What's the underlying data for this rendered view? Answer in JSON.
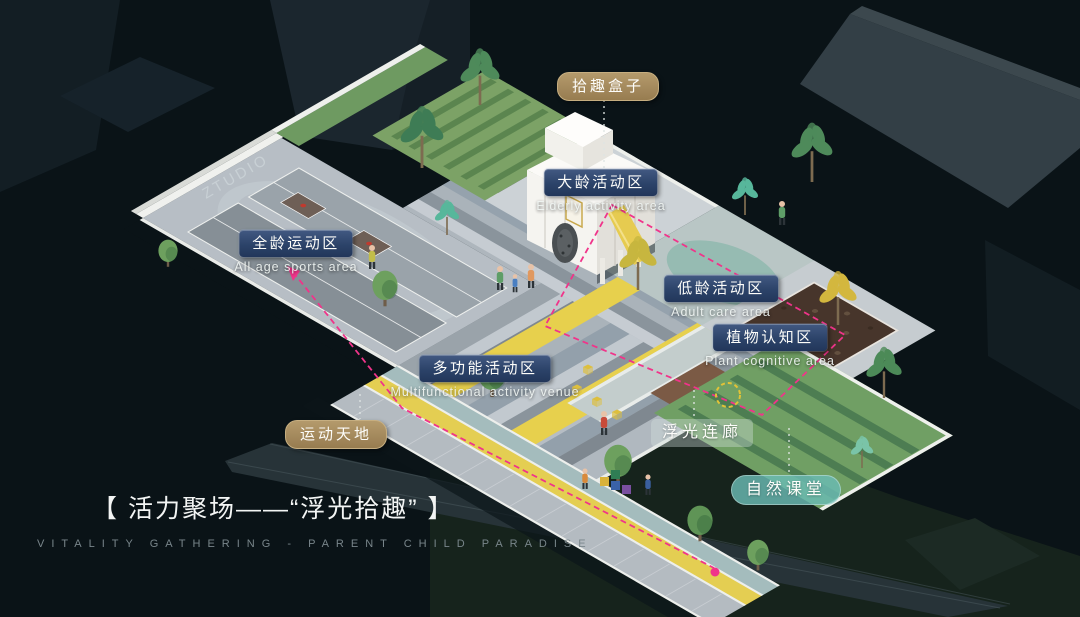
{
  "scene": {
    "title": "【 活力聚场——“浮光拾趣” 】",
    "subtitle": "VITALITY GATHERING - PARENT CHILD PARADISE",
    "watermark": "ZTUDIO"
  },
  "labels": {
    "box": {
      "zh": "拾趣盒子"
    },
    "elderly": {
      "zh": "大龄活动区",
      "en": "Elderly activity area"
    },
    "allage": {
      "zh": "全龄运动区",
      "en": "All age sports area"
    },
    "young": {
      "zh": "低龄活动区",
      "en": "Adult care area"
    },
    "plant": {
      "zh": "植物认知区",
      "en": "Plant cognitive area"
    },
    "multi": {
      "zh": "多功能活动区",
      "en": "Multifunctional activity venue"
    },
    "sports": {
      "zh": "运动天地"
    },
    "corridor": {
      "zh": "浮光连廊"
    },
    "nature": {
      "zh": "自然课堂"
    }
  },
  "colors": {
    "navy_chip": "#2c4369",
    "tan_chip": "#a3885e",
    "teal_chip": "#6abbb3",
    "route_magenta": "#f0348a",
    "stripe_yellow": "#e7d04d",
    "background": "#0a1317"
  }
}
